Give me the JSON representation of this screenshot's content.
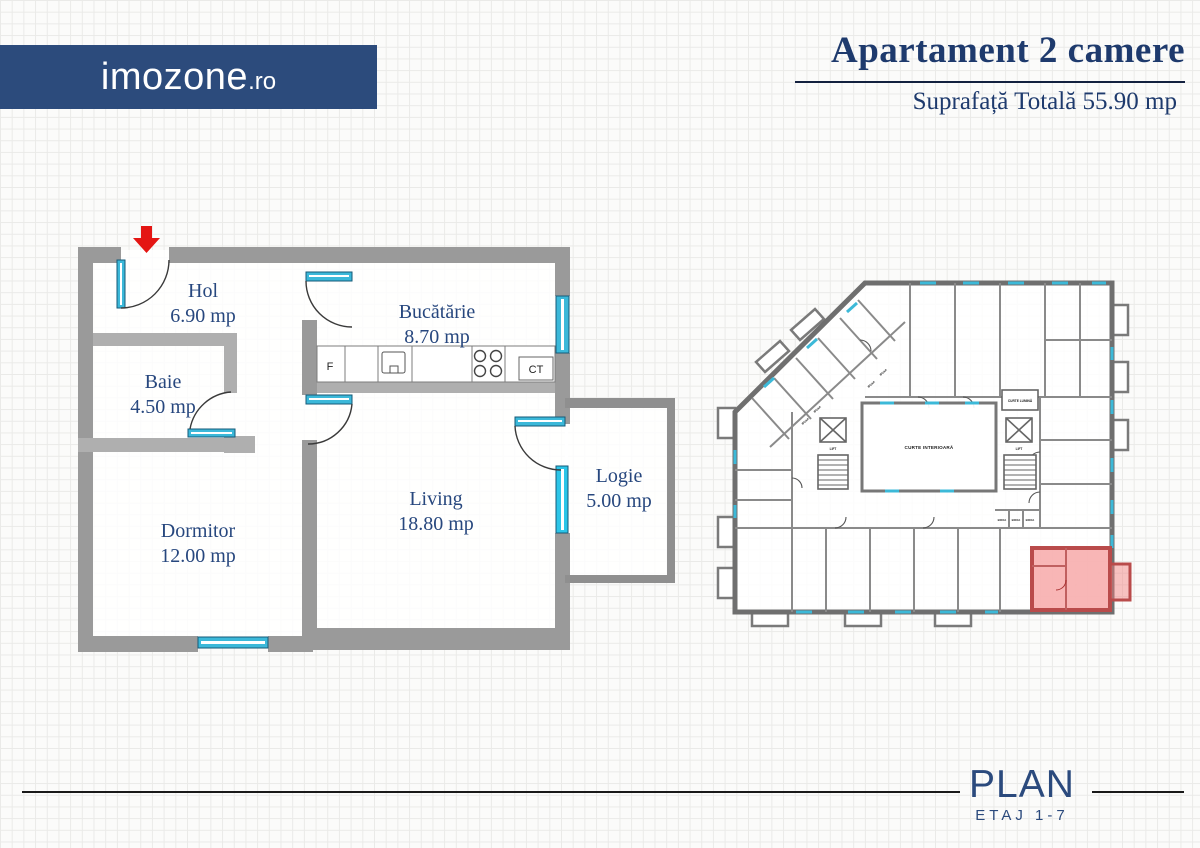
{
  "header": {
    "logo_text": "imozone",
    "logo_suffix": ".ro",
    "title": "Apartament 2 camere",
    "subtitle": "Suprafață Totală 55.90 mp"
  },
  "floorplan": {
    "rooms": [
      {
        "name": "Hol",
        "area": "6.90 mp"
      },
      {
        "name": "Baie",
        "area": "4.50 mp"
      },
      {
        "name": "Bucătărie",
        "area": "8.70 mp"
      },
      {
        "name": "Dormitor",
        "area": "12.00 mp"
      },
      {
        "name": "Living",
        "area": "18.80 mp"
      },
      {
        "name": "Logie",
        "area": "5.00 mp"
      }
    ],
    "fixtures": {
      "fridge": "F",
      "boiler": "CT"
    }
  },
  "site_plan": {
    "courtyard_label": "CURTE INTERIOARĂ",
    "light_court_label": "CURTE LUMINĂ",
    "lift_label": "LIFT",
    "storage_label": "BOXA"
  },
  "footer": {
    "plan_label": "PLAN",
    "floor_label": "ETAJ 1-7"
  },
  "colors": {
    "banner": "#2c4b7c",
    "heading_text": "#1e3a6d",
    "room_text": "#27477e",
    "wall": "#9a9a9a",
    "wall_light": "#afafaf",
    "window_cyan": "#3bb8d9",
    "window_bright": "#2cc5e8",
    "arrow_red": "#e41513",
    "highlight_fill": "#f27a7a",
    "highlight_wall": "#b94b4b"
  }
}
